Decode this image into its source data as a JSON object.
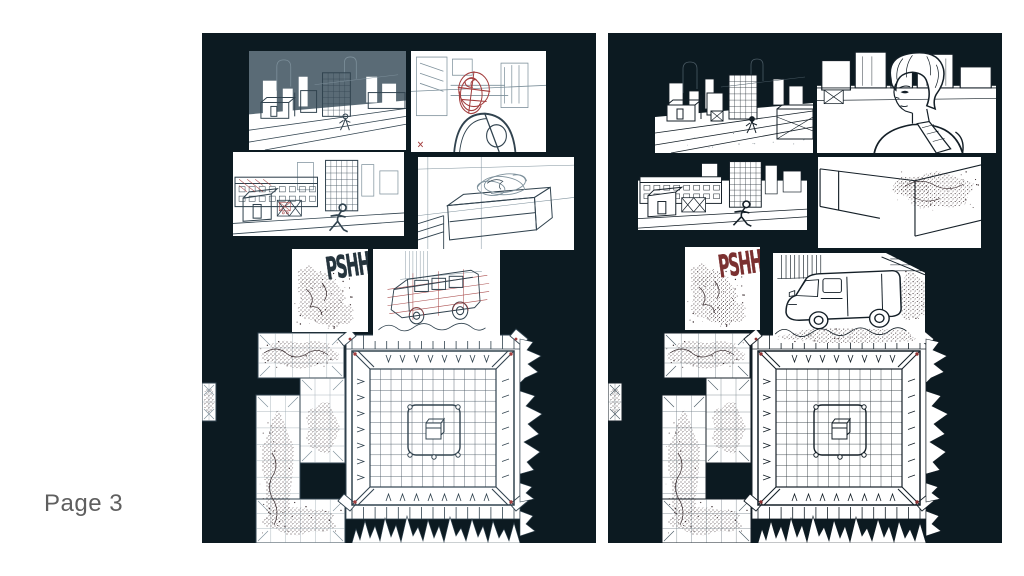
{
  "page_label": "Page 3",
  "pages": [
    {
      "id": "left",
      "variant": "sketch",
      "sfx": "PSHH"
    },
    {
      "id": "right",
      "variant": "ink",
      "sfx": "PSHH"
    }
  ],
  "panels": [
    "city-establishing-shot",
    "figure-overlooking-city",
    "street-run",
    "container-smoke",
    "sfx-smoke-burst",
    "van-arrival",
    "smoke-duct-and-grid-room"
  ],
  "colors": {
    "canvas_bg": "#ffffff",
    "page_bg": "#0c1a21",
    "sketch_sky": "#5a6b76",
    "sketch_line": "#31434f",
    "sketch_light": "#7d909b",
    "sketch_red": "#a33e3e",
    "ink_line": "#141f27",
    "sfx_sketch": "#25343d",
    "sfx_ink": "#7b3030",
    "smoke_stipple": "#35272a",
    "label_text": "#5f5f5f"
  }
}
